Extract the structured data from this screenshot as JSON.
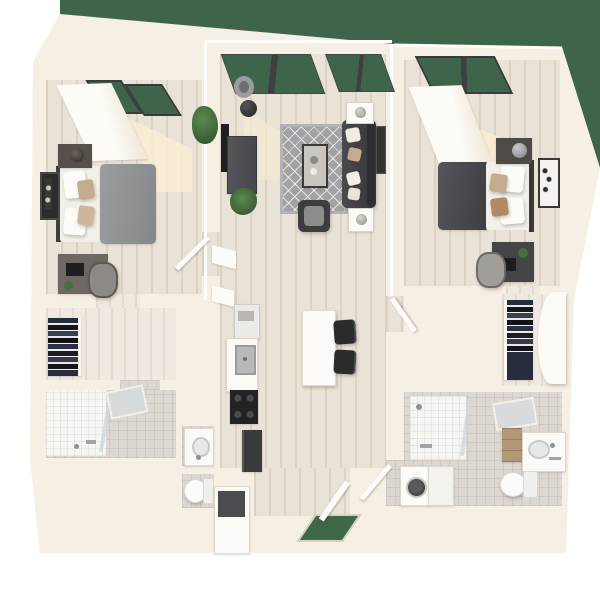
{
  "scene": {
    "kind": "3d-floor-plan-render-top-view",
    "subject": "two-bedroom two-bath apartment unit",
    "background": "white",
    "exterior": {
      "lawn": "dark green grass visible above the unit and past the top-right corner and through all window walls",
      "entry_doormat": "green mat in the front-door opening at bottom center"
    }
  },
  "palette": {
    "bg": "#ffffff",
    "grass": "#3e6549",
    "wall": "#f6efe3",
    "wallShade": "#efe6d7",
    "wallEdge": "#fffdf7",
    "floor": "#e9e2d6",
    "floorLight": "#efe9df",
    "floorStreak": "rgba(186,170,148,0.28)",
    "tileBath": "#dcd7d0",
    "showerTile": "#f5f5f2",
    "rug": "#a2a2a4",
    "rugLine": "rgba(255,255,255,0.7)",
    "charcoal": "#3f3f43",
    "duvetGray": "#8f9194",
    "duvetDark": "#47474c",
    "linen": "#f3f0ea",
    "tan": "#c5ab8d",
    "furnWhite": "#fbfaf6",
    "applianceDark": "#2b2b2e",
    "metal": "#a8abad",
    "plant": "#47703f",
    "plantDark": "#2f4d2b",
    "mat": "#3f684b",
    "woodFurn": "#b29877",
    "sun": "#f9ecd4"
  },
  "rooms": [
    {
      "id": "bedroom-1",
      "position": "top-left",
      "contents": [
        "window-wall-with-lawn-view",
        "white-closet-volume",
        "sunlight-patch",
        "floor-plant",
        "bed-gray-duvet-white-and-tan-pillows",
        "nightstand-with-dark-lamp",
        "framed-wall-art",
        "desk-with-chair",
        "door-to-hall"
      ]
    },
    {
      "id": "living-room",
      "position": "top-center",
      "contents": [
        "window-wall-with-lawn-view",
        "arc-floor-lamp-black-sphere",
        "wall-mounted-tv",
        "media-console",
        "floor-plant",
        "diamond-pattern-area-rug",
        "coffee-table-with-decor",
        "charcoal-sofa-with-throw-pillows",
        "two-side-tables-with-lamps",
        "armchair",
        "framed-wall-art",
        "sunlight-patch"
      ]
    },
    {
      "id": "bedroom-2",
      "position": "top-right",
      "contents": [
        "window-wall-with-lawn-view",
        "white-closet-volume",
        "sunlight-patch",
        "bed-charcoal-duvet-white-and-tan-pillows",
        "nightstand-with-sphere-lamp",
        "framed-wall-art",
        "desk-with-plant-and-laptop",
        "desk-chair",
        "door-to-hall"
      ]
    },
    {
      "id": "kitchen",
      "position": "center-left-of-corridor",
      "contents": [
        "refrigerator",
        "floating-shelves",
        "counter-with-sink",
        "range-cooktop-black",
        "oven-dishwasher-dark"
      ]
    },
    {
      "id": "dining",
      "position": "center",
      "contents": [
        "white-island-table",
        "two-dark-stools"
      ]
    },
    {
      "id": "walk-in-closet-1",
      "position": "mid-left",
      "contents": [
        "shelves-with-folded-clothes"
      ]
    },
    {
      "id": "bathroom-1",
      "position": "lower-left",
      "contents": [
        "tiled-walk-in-shower",
        "glass-shower-door",
        "mirror",
        "vanity-sink",
        "toilet"
      ]
    },
    {
      "id": "walk-in-closet-2",
      "position": "mid-right",
      "contents": [
        "shelves-with-folded-clothes",
        "open-white-door"
      ]
    },
    {
      "id": "bathroom-2",
      "position": "lower-right",
      "contents": [
        "tiled-walk-in-shower",
        "glass-panel",
        "mirror",
        "wood-drawer-vanity",
        "counter-sink",
        "toilet"
      ]
    },
    {
      "id": "laundry",
      "position": "bottom-right-of-corridor",
      "contents": [
        "front-load-washer",
        "dryer",
        "louvered-door"
      ]
    },
    {
      "id": "entry",
      "position": "bottom-center",
      "contents": [
        "open-front-door",
        "green-doormat",
        "entry-closet-with-open-top"
      ]
    }
  ]
}
